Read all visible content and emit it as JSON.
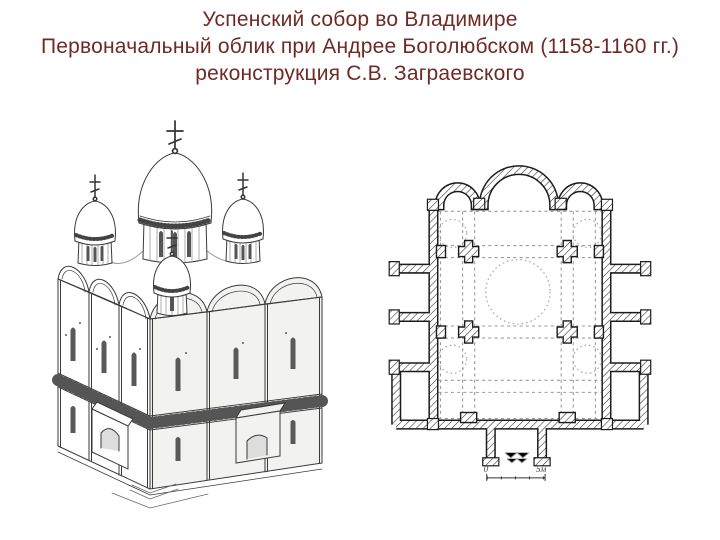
{
  "slide": {
    "background": "#ffffff",
    "line_color": "#3a3a3a",
    "title": {
      "color": "#6e2a24",
      "line1": "Успенский собор во Владимире",
      "line2": "Первоначальный облик при Андрее Боголюбском (1158-1160 гг.)",
      "line3": "реконструкция С.В. Заграевского"
    },
    "figures": {
      "floor_plan": {
        "scale": {
          "zero_label": "0",
          "end_label": "5м"
        }
      }
    }
  }
}
